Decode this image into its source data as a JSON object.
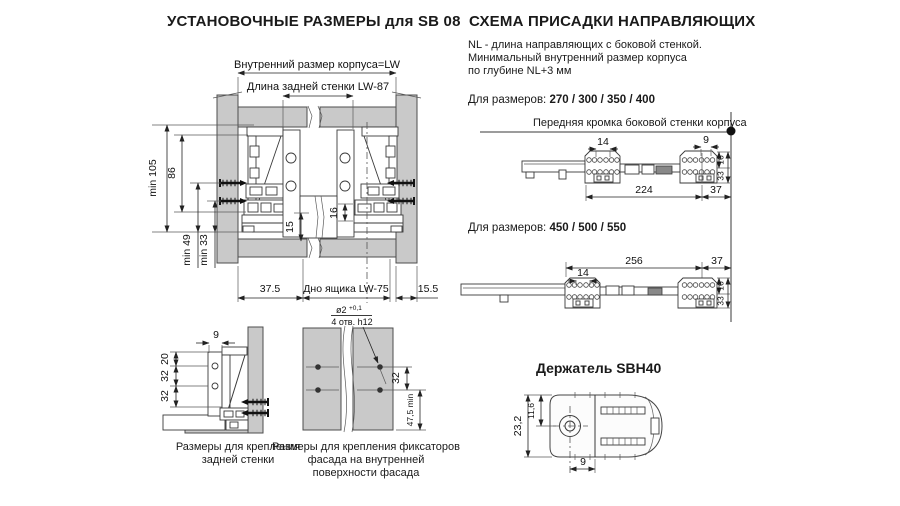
{
  "left_section": {
    "title": "УСТАНОВОЧНЫЕ РАЗМЕРЫ для SB 08",
    "main_drawing": {
      "dim_inner_width": "Внутренний размер корпуса=LW",
      "dim_back_wall_length": "Длина задней стенки  LW-87",
      "dim_min_105": "min 105",
      "dim_86": "86",
      "dim_min_49": "min 49",
      "dim_min_33": "min 33",
      "dim_15": "15",
      "dim_16": "16",
      "dim_37_5": "37.5",
      "dim_drawer_bottom": "Дно ящика  LW-75",
      "dim_15_5": "15.5"
    },
    "back_wall_detail": {
      "dim_9": "9",
      "dim_20": "20",
      "dim_32_upper": "32",
      "dim_32_lower": "32",
      "caption_line1": "Размеры  для крепления",
      "caption_line2": "задней стенки"
    },
    "facade_detail": {
      "hole_diameter": "ø2",
      "hole_tolerance": "+0,1",
      "hole_count": "4 отв. h12",
      "dim_32": "32",
      "dim_47_5_min": "47,5 min",
      "caption_line1": "Размеры для крепления фиксаторов",
      "caption_line2": "фасада на внутренней",
      "caption_line3": "поверхности фасада"
    }
  },
  "right_section": {
    "title": "СХЕМА ПРИСАДКИ НАПРАВЛЯЮЩИХ",
    "note_line1": "NL - длина направляющих с боковой стенкой.",
    "note_line2": "Минимальный внутренний размер корпуса",
    "note_line3": "по глубине NL+3 мм",
    "sizes_short_label": "Для размеров:",
    "sizes_short_values": "270 / 300 / 350 / 400",
    "front_edge_label": "Передняя кромка боковой стенки корпуса",
    "drawing_short": {
      "dim_14": "14",
      "dim_9": "9",
      "dim_224": "224",
      "dim_37": "37",
      "dim_33": "33",
      "dim_16": "16"
    },
    "sizes_long_label": "Для размеров:",
    "sizes_long_values": "450 / 500 / 550",
    "drawing_long": {
      "dim_256": "256",
      "dim_37": "37",
      "dim_14": "14",
      "dim_33": "33",
      "dim_16": "16"
    },
    "holder": {
      "title": "Держатель SBH40",
      "dim_23_2": "23,2",
      "dim_11_6": "11,6",
      "dim_9": "9"
    }
  },
  "colors": {
    "panel_fill": "#c9c9c9",
    "line": "#3a3a3a",
    "text": "#1a1a1a"
  }
}
